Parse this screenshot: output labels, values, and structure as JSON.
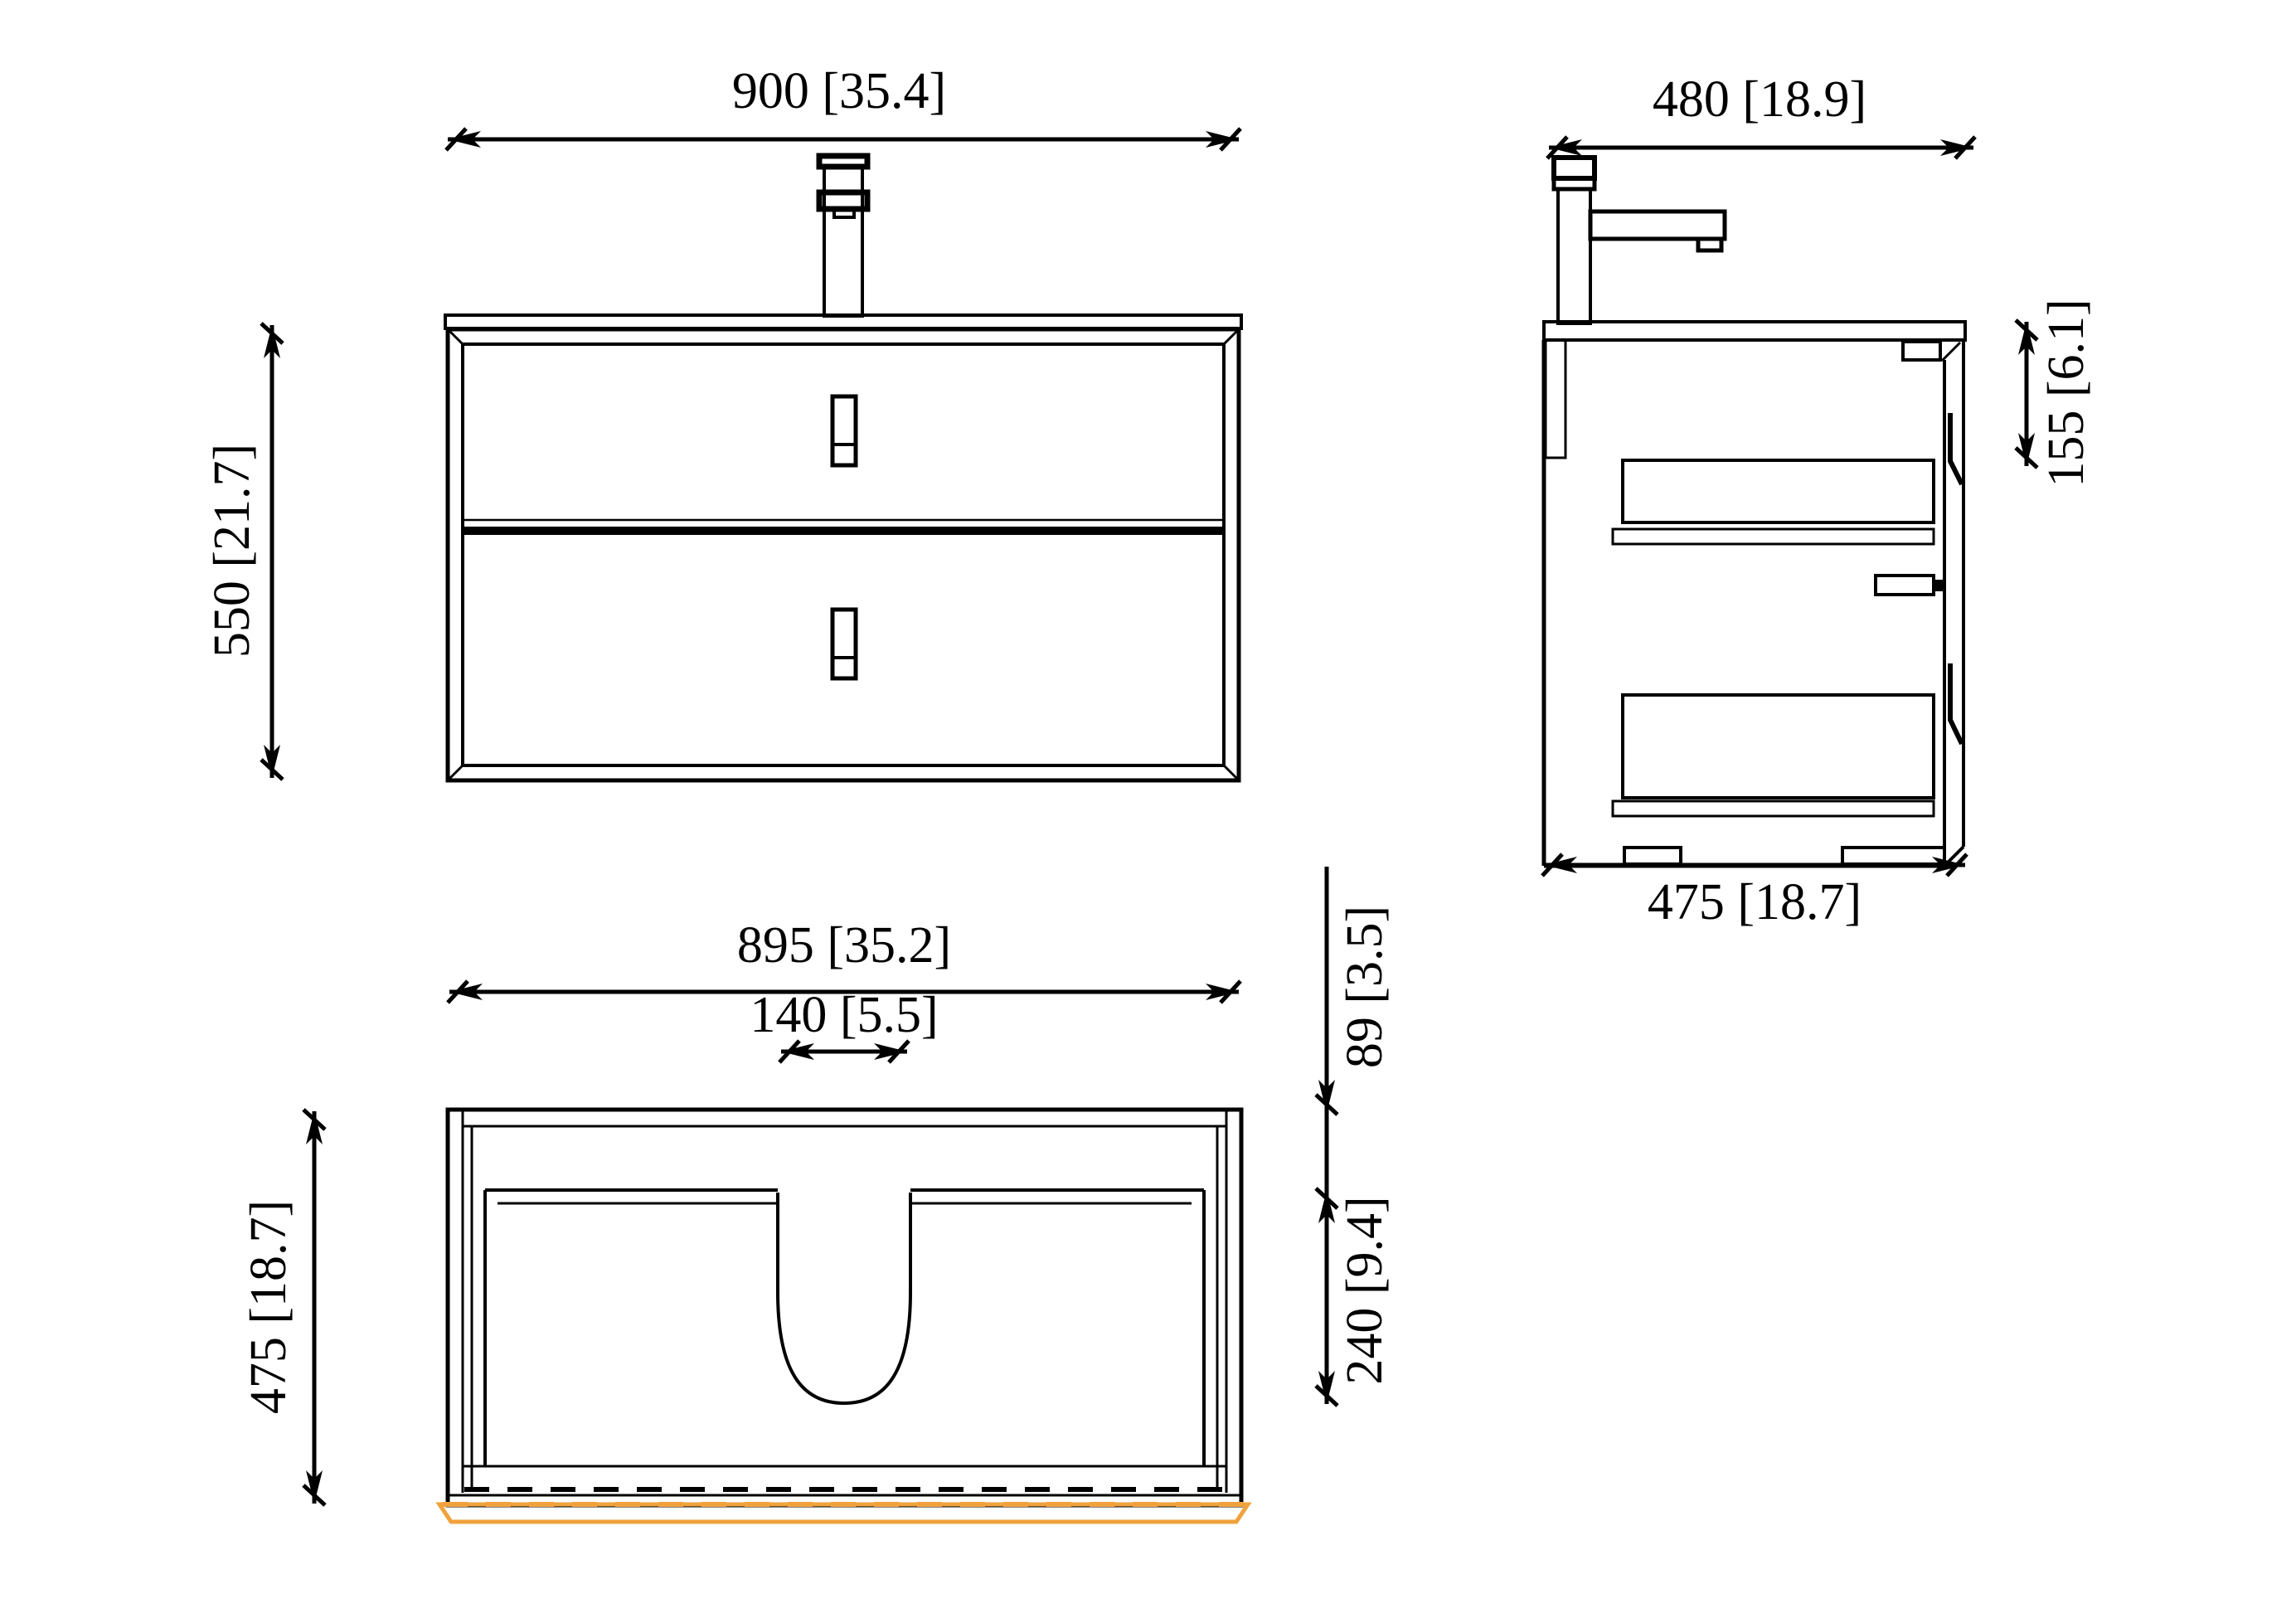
{
  "title": "Bathroom vanity cabinet technical drawing",
  "colors": {
    "line": "#000000",
    "accent_orange": "#f0a23c",
    "background": "#ffffff"
  },
  "views": {
    "front": {
      "label": "front-view",
      "width_dim": "900 [35.4]",
      "height_dim": "550 [21.7]"
    },
    "side": {
      "label": "side-view",
      "width_dim": "480 [18.9]",
      "handle_offset_dim": "155 [6.1]",
      "depth_dim": "475 [18.7]"
    },
    "plan": {
      "label": "top-view",
      "width_dim": "895 [35.2]",
      "cutout_dim": "140 [5.5]",
      "depth_dim": "475 [18.7]",
      "back_offset_dim": "89 [3.5]",
      "basin_depth_dim": "240 [9.4]"
    }
  }
}
